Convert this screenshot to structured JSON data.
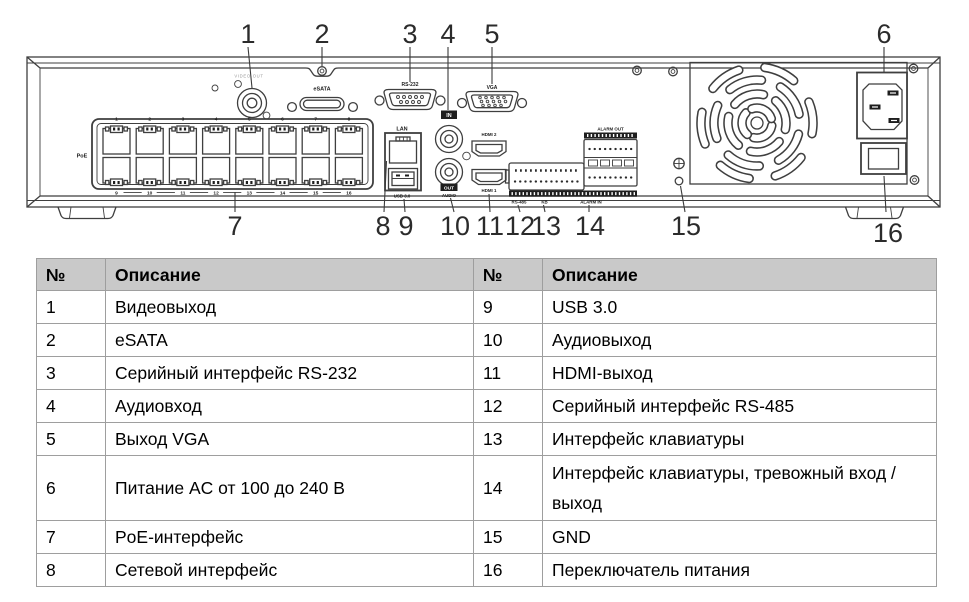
{
  "diagram": {
    "callouts": [
      "1",
      "2",
      "3",
      "4",
      "5",
      "6",
      "7",
      "8",
      "9",
      "10",
      "11",
      "12",
      "13",
      "14",
      "15",
      "16"
    ],
    "ports": {
      "video_out_label": "VIDEO OUT",
      "esata_label": "eSATA",
      "rs232_label": "RS-232",
      "audio_in_badge": "IN",
      "vga_label": "VGA",
      "lan_label": "LAN",
      "usb_label": "USB 3.0",
      "audio_out_badge": "OUT",
      "audio_out_label": "AUDIO",
      "hdmi2_label": "HDMI 2",
      "hdmi1_label": "HDMI 1",
      "poe_label": "PoE",
      "rs485_label": "RS-485",
      "kb_label": "KB",
      "alarm_out_label": "ALARM OUT",
      "alarm_in_label": "ALARM IN",
      "poe_numbers_top": [
        "1",
        "2",
        "3",
        "4",
        "5",
        "6",
        "7",
        "8"
      ],
      "poe_numbers_bottom": [
        "9",
        "10",
        "11",
        "12",
        "13",
        "14",
        "15",
        "16"
      ]
    }
  },
  "table": {
    "header": {
      "num1": "№",
      "desc1": "Описание",
      "num2": "№",
      "desc2": "Описание"
    },
    "rows": [
      {
        "num1": "1",
        "desc1": "Видеовыход",
        "num2": "9",
        "desc2": "USB 3.0"
      },
      {
        "num1": "2",
        "desc1": "eSATA",
        "num2": "10",
        "desc2": "Аудиовыход"
      },
      {
        "num1": "3",
        "desc1": "Серийный интерфейс RS-232",
        "num2": "11",
        "desc2": "HDMI-выход"
      },
      {
        "num1": "4",
        "desc1": "Аудиовход",
        "num2": "12",
        "desc2": "Серийный интерфейс RS-485"
      },
      {
        "num1": "5",
        "desc1": "Выход VGA",
        "num2": "13",
        "desc2": "Интерфейс клавиатуры"
      },
      {
        "num1": "6",
        "desc1": "Питание AC от 100 до 240 В",
        "num2": "14",
        "desc2": "Интерфейс клавиатуры, тревожный вход / выход"
      },
      {
        "num1": "7",
        "desc1": "PoE-интерфейс",
        "num2": "15",
        "desc2": "GND"
      },
      {
        "num1": "8",
        "desc1": "Сетевой интерфейс",
        "num2": "16",
        "desc2": "Переключатель питания"
      }
    ]
  }
}
